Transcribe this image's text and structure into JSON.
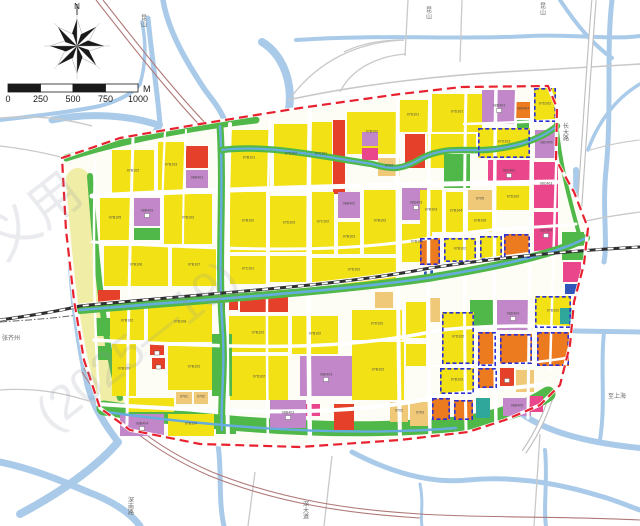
{
  "compass": {
    "label": "N"
  },
  "scalebar": {
    "ticks": [
      "0",
      "250",
      "500",
      "750",
      "1000"
    ],
    "unit": "M"
  },
  "watermarks": [
    {
      "t": "义用",
      "x": 4,
      "y": 262,
      "s": 52,
      "r": -38
    },
    {
      "t": "(2025—19)",
      "x": 52,
      "y": 432,
      "s": 48,
      "r": -38
    }
  ],
  "edge_labels": [
    {
      "t": "昆山",
      "x": 141,
      "y": 14,
      "v": 1
    },
    {
      "t": "昆山",
      "x": 426,
      "y": 6,
      "v": 1
    },
    {
      "t": "昆山",
      "x": 540,
      "y": 2,
      "v": 1
    },
    {
      "t": "张齐州",
      "x": 2,
      "y": 334,
      "v": 0
    },
    {
      "t": "深南路",
      "x": 128,
      "y": 496,
      "v": 1
    },
    {
      "t": "深大道",
      "x": 303,
      "y": 500,
      "v": 1
    },
    {
      "t": "长大路",
      "x": 563,
      "y": 122,
      "v": 1
    },
    {
      "t": "至上海",
      "x": 608,
      "y": 392,
      "v": 0
    }
  ],
  "palette": {
    "Y": "#f2e215",
    "R": "#e5402a",
    "G": "#4fb848",
    "V": "#c287c9",
    "M": "#e9468c",
    "O": "#ec7a1f",
    "T": "#efc978",
    "E": "#2fa89b",
    "B": "#2f56b8",
    "pale": "#f0eda6",
    "water": "#a9cbe9",
    "canal": "#66acde",
    "boundary": "#e8212e",
    "dash_blue": "#2b2fd4",
    "road_outside": "#c9c9c9",
    "railway": "#b07878",
    "label_ink": "#4a4a4a"
  },
  "parcels": [
    {
      "x": 112,
      "y": 150,
      "w": 42,
      "h": 44,
      "c": "Y",
      "l": "07B102"
    },
    {
      "x": 158,
      "y": 142,
      "w": 26,
      "h": 48,
      "c": "Y",
      "l": "07B103"
    },
    {
      "x": 186,
      "y": 146,
      "w": 22,
      "h": 22,
      "c": "R"
    },
    {
      "x": 186,
      "y": 170,
      "w": 22,
      "h": 18,
      "c": "V",
      "l": "08B401"
    },
    {
      "x": 100,
      "y": 198,
      "w": 30,
      "h": 42,
      "c": "Y",
      "l": "07B105"
    },
    {
      "x": 134,
      "y": 198,
      "w": 26,
      "h": 28,
      "c": "V",
      "l": "08B403",
      "i": 1
    },
    {
      "x": 134,
      "y": 228,
      "w": 26,
      "h": 12,
      "c": "G"
    },
    {
      "x": 164,
      "y": 194,
      "w": 48,
      "h": 50,
      "c": "Y",
      "l": "07B102"
    },
    {
      "x": 104,
      "y": 246,
      "w": 64,
      "h": 40,
      "c": "Y",
      "l": "07B106"
    },
    {
      "x": 172,
      "y": 246,
      "w": 44,
      "h": 40,
      "c": "Y",
      "l": "07B107"
    },
    {
      "x": 98,
      "y": 290,
      "w": 22,
      "h": 12,
      "c": "R"
    },
    {
      "x": 110,
      "y": 304,
      "w": 34,
      "h": 36,
      "c": "Y",
      "l": "07B102"
    },
    {
      "x": 148,
      "y": 304,
      "w": 64,
      "h": 38,
      "c": "Y",
      "l": "07B108"
    },
    {
      "x": 112,
      "y": 344,
      "w": 24,
      "h": 52,
      "c": "Y",
      "l": "07B109"
    },
    {
      "x": 168,
      "y": 346,
      "w": 52,
      "h": 44,
      "c": "Y",
      "l": "07B102"
    },
    {
      "x": 150,
      "y": 344,
      "w": 14,
      "h": 11,
      "c": "R",
      "i": 1
    },
    {
      "x": 152,
      "y": 358,
      "w": 13,
      "h": 11,
      "c": "R",
      "i": 1
    },
    {
      "x": 176,
      "y": 392,
      "w": 16,
      "h": 12,
      "c": "T",
      "l": "0701"
    },
    {
      "x": 194,
      "y": 392,
      "w": 14,
      "h": 12,
      "c": "T",
      "l": "0702"
    },
    {
      "x": 128,
      "y": 398,
      "w": 46,
      "h": 14,
      "c": "Y"
    },
    {
      "x": 120,
      "y": 414,
      "w": 44,
      "h": 22,
      "c": "V",
      "l": "08B404",
      "i": 1
    },
    {
      "x": 168,
      "y": 414,
      "w": 46,
      "h": 22,
      "c": "Y",
      "l": "07B104"
    },
    {
      "x": 216,
      "y": 416,
      "w": 20,
      "h": 18,
      "c": "G"
    },
    {
      "x": 228,
      "y": 130,
      "w": 42,
      "h": 58,
      "c": "Y",
      "l": "07B101"
    },
    {
      "x": 274,
      "y": 124,
      "w": 34,
      "h": 62,
      "c": "Y",
      "l": "07D102"
    },
    {
      "x": 230,
      "y": 192,
      "w": 36,
      "h": 60,
      "c": "Y",
      "l": "07B102"
    },
    {
      "x": 270,
      "y": 196,
      "w": 38,
      "h": 56,
      "c": "Y",
      "l": "07D103"
    },
    {
      "x": 230,
      "y": 256,
      "w": 36,
      "h": 28,
      "c": "Y",
      "l": "07C101"
    },
    {
      "x": 270,
      "y": 256,
      "w": 38,
      "h": 26,
      "c": "Y"
    },
    {
      "x": 240,
      "y": 290,
      "w": 48,
      "h": 22,
      "c": "R"
    },
    {
      "x": 222,
      "y": 296,
      "w": 16,
      "h": 14,
      "c": "R"
    },
    {
      "x": 228,
      "y": 316,
      "w": 60,
      "h": 36,
      "c": "Y",
      "l": "07B102"
    },
    {
      "x": 230,
      "y": 356,
      "w": 58,
      "h": 44,
      "c": "Y",
      "l": "07D102"
    },
    {
      "x": 292,
      "y": 316,
      "w": 46,
      "h": 38,
      "c": "Y",
      "l": "07B102"
    },
    {
      "x": 212,
      "y": 334,
      "w": 20,
      "h": 62,
      "c": "G"
    },
    {
      "x": 300,
      "y": 356,
      "w": 52,
      "h": 40,
      "c": "V",
      "l": "08D403",
      "i": 1
    },
    {
      "x": 270,
      "y": 400,
      "w": 36,
      "h": 28,
      "c": "V",
      "l": "08B403",
      "i": 1
    },
    {
      "x": 306,
      "y": 404,
      "w": 14,
      "h": 12,
      "c": "M"
    },
    {
      "x": 334,
      "y": 404,
      "w": 20,
      "h": 26,
      "c": "R"
    },
    {
      "x": 352,
      "y": 342,
      "w": 52,
      "h": 58,
      "c": "Y",
      "l": "07B102"
    },
    {
      "x": 352,
      "y": 310,
      "w": 50,
      "h": 30,
      "c": "Y",
      "l": "07D102"
    },
    {
      "x": 375,
      "y": 292,
      "w": 18,
      "h": 16,
      "c": "T"
    },
    {
      "x": 390,
      "y": 402,
      "w": 18,
      "h": 20,
      "c": "T",
      "l": "0702"
    },
    {
      "x": 410,
      "y": 402,
      "w": 20,
      "h": 24,
      "c": "T",
      "l": "0703"
    },
    {
      "x": 406,
      "y": 302,
      "w": 20,
      "h": 36,
      "c": "Y"
    },
    {
      "x": 406,
      "y": 344,
      "w": 20,
      "h": 22,
      "c": "Y"
    },
    {
      "x": 310,
      "y": 122,
      "w": 22,
      "h": 66,
      "c": "Y",
      "l": "07C101"
    },
    {
      "x": 333,
      "y": 120,
      "w": 12,
      "h": 74,
      "c": "R"
    },
    {
      "x": 347,
      "y": 112,
      "w": 50,
      "h": 42,
      "c": "Y",
      "l": "07B102"
    },
    {
      "x": 362,
      "y": 132,
      "w": 16,
      "h": 14,
      "c": "V"
    },
    {
      "x": 362,
      "y": 148,
      "w": 16,
      "h": 12,
      "c": "M"
    },
    {
      "x": 398,
      "y": 100,
      "w": 30,
      "h": 32,
      "c": "Y",
      "l": "07D101"
    },
    {
      "x": 405,
      "y": 134,
      "w": 20,
      "h": 34,
      "c": "R"
    },
    {
      "x": 427,
      "y": 134,
      "w": 18,
      "h": 34,
      "c": "Y"
    },
    {
      "x": 378,
      "y": 158,
      "w": 22,
      "h": 18,
      "c": "T",
      "l": "0704"
    },
    {
      "x": 312,
      "y": 192,
      "w": 22,
      "h": 62,
      "c": "Y",
      "l": "07C102"
    },
    {
      "x": 338,
      "y": 192,
      "w": 22,
      "h": 26,
      "c": "V",
      "l": "08B402"
    },
    {
      "x": 338,
      "y": 222,
      "w": 22,
      "h": 32,
      "c": "Y",
      "l": "07B103"
    },
    {
      "x": 364,
      "y": 190,
      "w": 32,
      "h": 64,
      "c": "Y",
      "l": "07B102"
    },
    {
      "x": 402,
      "y": 188,
      "w": 28,
      "h": 32,
      "c": "V",
      "l": "08D403",
      "i": 1
    },
    {
      "x": 402,
      "y": 224,
      "w": 30,
      "h": 38,
      "c": "Y",
      "l": "07B102"
    },
    {
      "x": 312,
      "y": 258,
      "w": 84,
      "h": 26,
      "c": "Y",
      "l": "07D102"
    },
    {
      "x": 432,
      "y": 94,
      "w": 50,
      "h": 38,
      "c": "Y",
      "l": "07D101"
    },
    {
      "x": 432,
      "y": 134,
      "w": 44,
      "h": 16,
      "c": "Y"
    },
    {
      "x": 444,
      "y": 154,
      "w": 26,
      "h": 34,
      "c": "G"
    },
    {
      "x": 420,
      "y": 190,
      "w": 22,
      "h": 42,
      "c": "Y",
      "l": "07B103"
    },
    {
      "x": 446,
      "y": 192,
      "w": 20,
      "h": 40,
      "c": "Y",
      "l": "07B104"
    },
    {
      "x": 468,
      "y": 190,
      "w": 24,
      "h": 20,
      "c": "T",
      "l": "0705"
    },
    {
      "x": 468,
      "y": 212,
      "w": 24,
      "h": 20,
      "c": "Y",
      "l": "07B105"
    },
    {
      "x": 496,
      "y": 186,
      "w": 34,
      "h": 24,
      "c": "Y",
      "l": "07D102"
    },
    {
      "x": 482,
      "y": 90,
      "w": 34,
      "h": 34,
      "c": "V",
      "l": "08D403",
      "i": 1
    },
    {
      "x": 516,
      "y": 102,
      "w": 14,
      "h": 16,
      "c": "O",
      "l": "08D404"
    },
    {
      "x": 517,
      "y": 120,
      "w": 12,
      "h": 8,
      "c": "G"
    },
    {
      "x": 534,
      "y": 88,
      "w": 22,
      "h": 34,
      "c": "Y",
      "l": "07D102",
      "d": 1
    },
    {
      "x": 478,
      "y": 128,
      "w": 52,
      "h": 30,
      "c": "Y",
      "l": "07D103",
      "d": 1
    },
    {
      "x": 535,
      "y": 130,
      "w": 23,
      "h": 28,
      "c": "V",
      "l": "08D405"
    },
    {
      "x": 488,
      "y": 160,
      "w": 42,
      "h": 24,
      "c": "M",
      "l": "08C402",
      "i": 1
    },
    {
      "x": 534,
      "y": 162,
      "w": 24,
      "h": 46,
      "c": "M",
      "l": "08C403"
    },
    {
      "x": 534,
      "y": 212,
      "w": 24,
      "h": 40,
      "c": "M",
      "l": "08C404",
      "i": 1
    },
    {
      "x": 562,
      "y": 232,
      "w": 22,
      "h": 28,
      "c": "G"
    },
    {
      "x": 563,
      "y": 262,
      "w": 18,
      "h": 20,
      "c": "M"
    },
    {
      "x": 565,
      "y": 284,
      "w": 12,
      "h": 10,
      "c": "B"
    },
    {
      "x": 420,
      "y": 238,
      "w": 20,
      "h": 27,
      "c": "O",
      "d": 1
    },
    {
      "x": 444,
      "y": 238,
      "w": 32,
      "h": 24,
      "c": "Y",
      "l": "07B102",
      "d": 1
    },
    {
      "x": 480,
      "y": 236,
      "w": 22,
      "h": 24,
      "c": "Y",
      "d": 1
    },
    {
      "x": 504,
      "y": 234,
      "w": 26,
      "h": 24,
      "c": "O",
      "d": 1
    },
    {
      "x": 424,
      "y": 270,
      "w": 9,
      "h": 9,
      "c": "B"
    },
    {
      "x": 470,
      "y": 300,
      "w": 24,
      "h": 28,
      "c": "G"
    },
    {
      "x": 497,
      "y": 300,
      "w": 32,
      "h": 30,
      "c": "V",
      "l": "08D403",
      "i": 1
    },
    {
      "x": 535,
      "y": 296,
      "w": 36,
      "h": 32,
      "c": "Y",
      "l": "07B102",
      "d": 1
    },
    {
      "x": 428,
      "y": 298,
      "w": 12,
      "h": 24,
      "c": "T"
    },
    {
      "x": 442,
      "y": 312,
      "w": 32,
      "h": 52,
      "c": "Y",
      "l": "07D102",
      "d": 1
    },
    {
      "x": 478,
      "y": 332,
      "w": 18,
      "h": 34,
      "c": "O",
      "d": 1
    },
    {
      "x": 500,
      "y": 334,
      "w": 32,
      "h": 30,
      "c": "O",
      "d": 1
    },
    {
      "x": 537,
      "y": 332,
      "w": 32,
      "h": 34,
      "c": "O",
      "d": 1
    },
    {
      "x": 500,
      "y": 368,
      "w": 14,
      "h": 18,
      "c": "R",
      "i": 1
    },
    {
      "x": 516,
      "y": 370,
      "w": 18,
      "h": 22,
      "c": "T"
    },
    {
      "x": 440,
      "y": 368,
      "w": 34,
      "h": 26,
      "c": "Y",
      "l": "07B103",
      "d": 1
    },
    {
      "x": 478,
      "y": 368,
      "w": 19,
      "h": 20,
      "c": "O",
      "d": 1
    },
    {
      "x": 432,
      "y": 398,
      "w": 18,
      "h": 22,
      "c": "O",
      "d": 1
    },
    {
      "x": 454,
      "y": 400,
      "w": 19,
      "h": 20,
      "c": "O",
      "d": 1
    },
    {
      "x": 476,
      "y": 398,
      "w": 14,
      "h": 20,
      "c": "E"
    },
    {
      "x": 503,
      "y": 398,
      "w": 28,
      "h": 18,
      "c": "V",
      "l": "08B405"
    },
    {
      "x": 527,
      "y": 396,
      "w": 16,
      "h": 16,
      "c": "M"
    },
    {
      "x": 560,
      "y": 308,
      "w": 12,
      "h": 16,
      "c": "E"
    },
    {
      "x": 96,
      "y": 318,
      "w": 14,
      "h": 18,
      "c": "G"
    },
    {
      "x": 98,
      "y": 346,
      "w": 12,
      "h": 14,
      "c": "G"
    }
  ]
}
